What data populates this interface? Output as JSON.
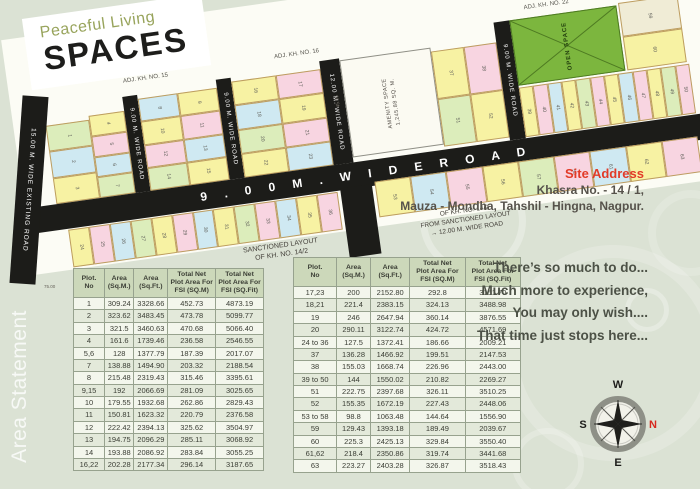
{
  "logo": {
    "line1": "Peaceful Living",
    "line2": "SPACES"
  },
  "plan": {
    "adjacent_labels": {
      "top_left": "ADJ. KH. NO. 15",
      "top_mid": "ADJ. KH. NO. 16",
      "top_right": "ADJ. KH. NO. 22",
      "right_edge": "ADJ. KH. NO. 20"
    },
    "roads": {
      "existing": "15.00 M. WIDE EXISTING ROAD",
      "r1": "9.00 M. WIDE ROAD",
      "r2": "9.00 M. WIDE ROAD",
      "r12": "12.00 M. WIDE ROAD",
      "r9b": "9.00 M. WIDE ROAD",
      "main": "9 . 0 0   M .   W I D E   R O A D"
    },
    "amenity": {
      "line1": "AMENITY SPACE",
      "line2": "1,245.88 SQ. M.",
      "dim": "45.55"
    },
    "open_space": {
      "label": "OPEN SPACE"
    },
    "dims": {
      "existing_road": "75.00"
    },
    "sanctioned_label_left": "SANCTIONED LAYOUT\nOF KH. NO. 14/2",
    "sanctioned_label_right": "OF KH. NO. 14/2\nFROM SANCTIONED LAYOUT\n→  12.00 M.  WIDE  ROAD",
    "blocks": {
      "a1": [
        {
          "n": "1",
          "c": "g"
        },
        {
          "n": "2",
          "c": "b"
        },
        {
          "n": "3",
          "c": "y"
        }
      ],
      "a2": [
        {
          "n": "4",
          "c": "y"
        },
        {
          "n": "5",
          "c": "p"
        },
        {
          "n": "6",
          "c": "b"
        },
        {
          "n": "7",
          "c": "g"
        }
      ],
      "b": [
        {
          "n": "8",
          "c": "b"
        },
        {
          "n": "9",
          "c": "y"
        },
        {
          "n": "10",
          "c": "y"
        },
        {
          "n": "11",
          "c": "p"
        },
        {
          "n": "12",
          "c": "p"
        },
        {
          "n": "13",
          "c": "b"
        },
        {
          "n": "14",
          "c": "g"
        },
        {
          "n": "15",
          "c": "y"
        }
      ],
      "c": [
        {
          "n": "16",
          "c": "y"
        },
        {
          "n": "17",
          "c": "p"
        },
        {
          "n": "18",
          "c": "b"
        },
        {
          "n": "19",
          "c": "y"
        },
        {
          "n": "20",
          "c": "g"
        },
        {
          "n": "21",
          "c": "p"
        },
        {
          "n": "22",
          "c": "y"
        },
        {
          "n": "23",
          "c": "b"
        }
      ],
      "d": [
        {
          "n": "37",
          "c": "y"
        },
        {
          "n": "38",
          "c": "p"
        },
        {
          "n": "51",
          "c": "g"
        },
        {
          "n": "52",
          "c": "y"
        }
      ],
      "e": [
        {
          "n": "39",
          "c": "y"
        },
        {
          "n": "40",
          "c": "p"
        },
        {
          "n": "41",
          "c": "b"
        },
        {
          "n": "42",
          "c": "y"
        },
        {
          "n": "43",
          "c": "g"
        },
        {
          "n": "44",
          "c": "p"
        },
        {
          "n": "45",
          "c": "y"
        },
        {
          "n": "46",
          "c": "b"
        },
        {
          "n": "47",
          "c": "p"
        },
        {
          "n": "48",
          "c": "y"
        },
        {
          "n": "49",
          "c": "g"
        },
        {
          "n": "50",
          "c": "p"
        }
      ],
      "f": [
        {
          "n": "59",
          "c": "c"
        },
        {
          "n": "60",
          "c": "y"
        }
      ],
      "g": [
        {
          "n": "24",
          "c": "y"
        },
        {
          "n": "25",
          "c": "p"
        },
        {
          "n": "26",
          "c": "b"
        },
        {
          "n": "27",
          "c": "g"
        },
        {
          "n": "28",
          "c": "y"
        },
        {
          "n": "29",
          "c": "p"
        },
        {
          "n": "30",
          "c": "b"
        },
        {
          "n": "31",
          "c": "y"
        },
        {
          "n": "32",
          "c": "g"
        },
        {
          "n": "33",
          "c": "p"
        },
        {
          "n": "34",
          "c": "b"
        },
        {
          "n": "35",
          "c": "y"
        },
        {
          "n": "36",
          "c": "p"
        }
      ],
      "h": [
        {
          "n": "53",
          "c": "y"
        },
        {
          "n": "54",
          "c": "b"
        },
        {
          "n": "55",
          "c": "p"
        },
        {
          "n": "56",
          "c": "y"
        },
        {
          "n": "57",
          "c": "g"
        },
        {
          "n": "58",
          "c": "p"
        },
        {
          "n": "61",
          "c": "b"
        },
        {
          "n": "62",
          "c": "y"
        },
        {
          "n": "63",
          "c": "p"
        }
      ]
    }
  },
  "site_address": {
    "title": "Site Address",
    "line1": "Khasra No. - 14 / 1,",
    "line2": "Mauza - Mondha, Tahshil - Hingna, Nagpur."
  },
  "area_statement_label": "Area Statement",
  "tables": {
    "headers": [
      "Plot.\nNo",
      "Area\n(Sq.M.)",
      "Area\n(Sq.Ft.)",
      "Total Net\nPlot Area For\nFSI (SQ.M)",
      "Total Net\nPlot Area For\nFSI (SQ.Fit)"
    ],
    "left_rows": [
      [
        "1",
        "309.24",
        "3328.66",
        "452.73",
        "4873.19"
      ],
      [
        "2",
        "323.62",
        "3483.45",
        "473.78",
        "5099.77"
      ],
      [
        "3",
        "321.5",
        "3460.63",
        "470.68",
        "5066.40"
      ],
      [
        "4",
        "161.6",
        "1739.46",
        "236.58",
        "2546.55"
      ],
      [
        "5,6",
        "128",
        "1377.79",
        "187.39",
        "2017.07"
      ],
      [
        "7",
        "138.88",
        "1494.90",
        "203.32",
        "2188.54"
      ],
      [
        "8",
        "215.48",
        "2319.43",
        "315.46",
        "3395.61"
      ],
      [
        "9,15",
        "192",
        "2066.69",
        "281.09",
        "3025.65"
      ],
      [
        "10",
        "179.55",
        "1932.68",
        "262.86",
        "2829.43"
      ],
      [
        "11",
        "150.81",
        "1623.32",
        "220.79",
        "2376.58"
      ],
      [
        "12",
        "222.42",
        "2394.13",
        "325.62",
        "3504.97"
      ],
      [
        "13",
        "194.75",
        "2096.29",
        "285.11",
        "3068.92"
      ],
      [
        "14",
        "193.88",
        "2086.92",
        "283.84",
        "3055.25"
      ],
      [
        "16,22",
        "202.28",
        "2177.34",
        "296.14",
        "3187.65"
      ]
    ],
    "right_rows": [
      [
        "17,23",
        "200",
        "2152.80",
        "292.8",
        "3151.70"
      ],
      [
        "18,21",
        "221.4",
        "2383.15",
        "324.13",
        "3488.98"
      ],
      [
        "19",
        "246",
        "2647.94",
        "360.14",
        "3876.55"
      ],
      [
        "20",
        "290.11",
        "3122.74",
        "424.72",
        "4571.69"
      ],
      [
        "24 to 36",
        "127.5",
        "1372.41",
        "186.66",
        "2009.21"
      ],
      [
        "37",
        "136.28",
        "1466.92",
        "199.51",
        "2147.53"
      ],
      [
        "38",
        "155.03",
        "1668.74",
        "226.96",
        "2443.00"
      ],
      [
        "39 to 50",
        "144",
        "1550.02",
        "210.82",
        "2269.27"
      ],
      [
        "51",
        "222.75",
        "2397.68",
        "326.11",
        "3510.25"
      ],
      [
        "52",
        "155.35",
        "1672.19",
        "227.43",
        "2448.06"
      ],
      [
        "53 to 58",
        "98.8",
        "1063.48",
        "144.64",
        "1556.90"
      ],
      [
        "59",
        "129.43",
        "1393.18",
        "189.49",
        "2039.67"
      ],
      [
        "60",
        "225.3",
        "2425.13",
        "329.84",
        "3550.40"
      ],
      [
        "61,62",
        "218.4",
        "2350.86",
        "319.74",
        "3441.68"
      ],
      [
        "63",
        "223.27",
        "2403.28",
        "326.87",
        "3518.43"
      ]
    ]
  },
  "quote": {
    "lines": [
      "There’s so much to do...",
      "Much more to experience,",
      "You may only wish....",
      "That time just stops here..."
    ]
  },
  "compass": {
    "n": "N",
    "s": "S",
    "e": "E",
    "w": "W"
  },
  "colors": {
    "page_bg": "#dbe2d4",
    "accent_red": "#e23b28",
    "road_black": "#1c1c19",
    "open_space_green": "#7cb63e",
    "table_header_bg": "#ccd8ba",
    "plot_palette": {
      "y": "#f7f2a3",
      "p": "#f8d5e1",
      "b": "#cfe9f2",
      "g": "#dcedbb",
      "c": "#f0ecd6"
    }
  }
}
